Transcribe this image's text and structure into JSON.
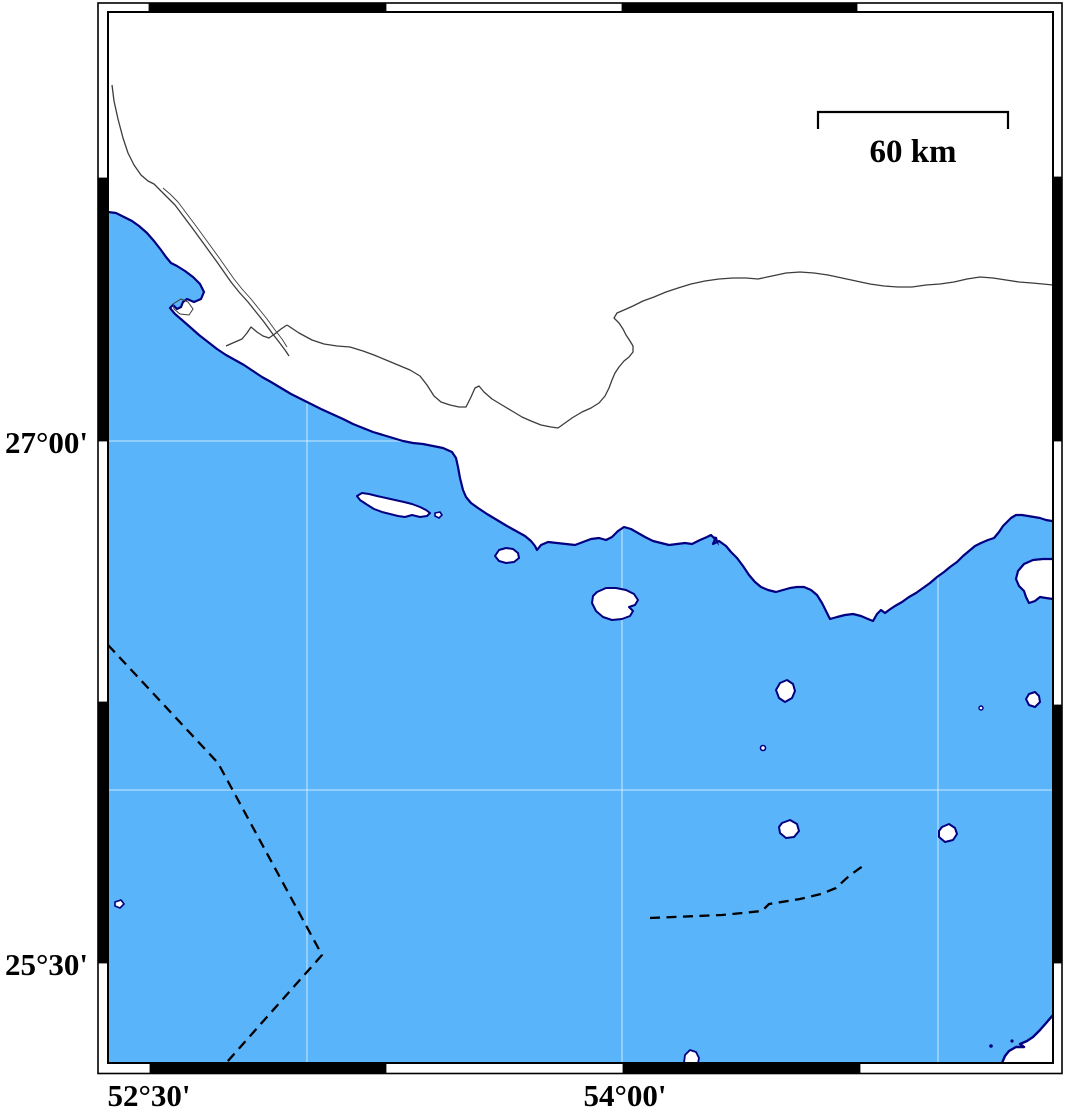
{
  "axis": {
    "left": [
      {
        "label": "27°00'"
      },
      {
        "label": "25°30'"
      }
    ],
    "bottom": [
      {
        "label": "52°30'"
      },
      {
        "label": "54°00'"
      }
    ]
  },
  "scale_bar": {
    "label": "60 km",
    "distance_km": 60
  },
  "graticule": {
    "meridians_shown": [
      "53°00'",
      "54°00'",
      "55°00'"
    ],
    "parallels_shown": [
      "27°00'",
      "26°00'"
    ]
  },
  "colors": {
    "sea": "#5AB4FA",
    "land": "#FFFFFF",
    "coastline": "#000080",
    "river": "#3C3C3C",
    "maritime_boundary_dash": "#000000",
    "gridline": "rgba(255,255,255,0.55)",
    "frame_black": "#000000",
    "frame_white": "#FFFFFF",
    "label_text": "#000000"
  }
}
